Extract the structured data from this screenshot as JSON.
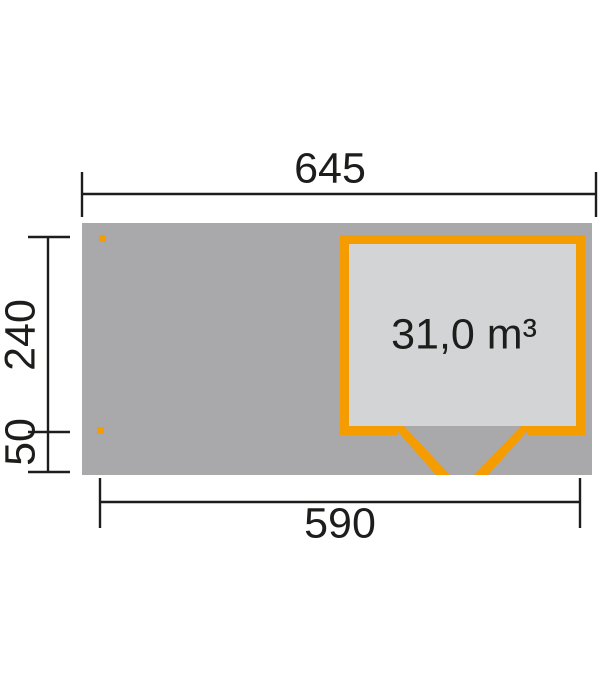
{
  "volume": {
    "label": "31,0 m³"
  },
  "dimensions": {
    "total_width": "645",
    "house_depth": "240",
    "deck_front_depth": "50",
    "base_width": "590"
  },
  "colors": {
    "accent_orange": "#f59c00",
    "deck_gray": "#a9a9ab",
    "interior_gray": "#d3d4d6",
    "line_black": "#1d1d1b",
    "background": "#ffffff"
  }
}
